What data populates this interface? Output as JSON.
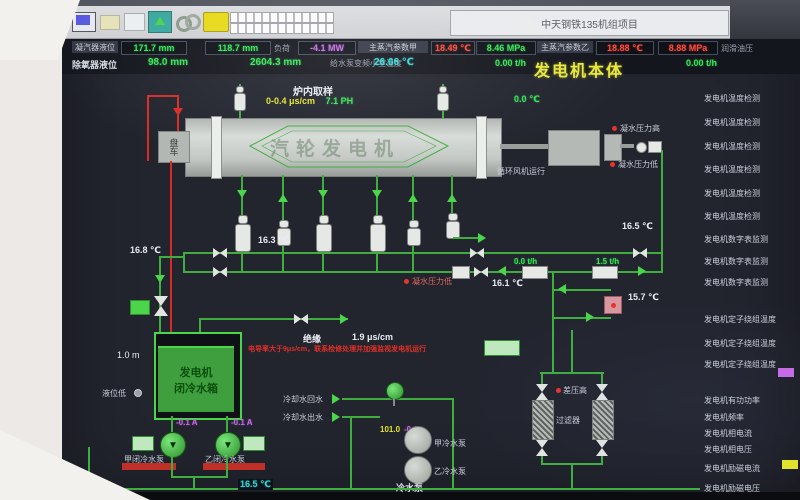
{
  "window": {
    "title": "中天钢铁135机组项目"
  },
  "toolbar": {
    "icon_names": [
      "monitor-icon",
      "open-icon",
      "page-icon",
      "trend-icon",
      "link-icon",
      "note-icon"
    ]
  },
  "status": {
    "row1": [
      {
        "label": "凝汽器液位"
      },
      {
        "value": "171.7 mm"
      },
      {
        "value": "118.7 mm"
      },
      {
        "label": "负荷"
      },
      {
        "value": "-4.1 MW"
      },
      {
        "label": "主蒸汽参数甲"
      },
      {
        "value": "18.49 ℃"
      },
      {
        "value": "8.46 MPa"
      },
      {
        "label": "主蒸汽参数乙"
      },
      {
        "value": "18.88 ℃"
      },
      {
        "value": "8.88 MPa"
      },
      {
        "label": "润滑油压"
      }
    ],
    "row2": [
      {
        "label": "除氧器液位"
      },
      {
        "value": "98.0 mm"
      },
      {
        "value": "2604.3 mm"
      },
      {
        "label": "给水泵变频小室温度"
      },
      {
        "value": "26.66 ℃"
      },
      {
        "value": "0.00 t/h"
      },
      {
        "value": "0.00 t/h"
      }
    ]
  },
  "diagram": {
    "title": "发电机本体",
    "generator_label": "汽轮发电机",
    "turning_gear": "盘车",
    "sampling_title": "炉内取样",
    "sampling_cond": "0-0.4 μs/cm",
    "sampling_ph": "7.1 PH",
    "fan_running": "循环风机运行",
    "press_high": "凝水压力高",
    "press_low": "凝水压力低",
    "press_low2": "凝水压力低",
    "t_top": "0.0 ℃",
    "t_168": "16.8 ℃",
    "t_163": "16.3 ℃",
    "t_165": "16.5 ℃",
    "t_161": "16.1 ℃",
    "t_157": "15.7 ℃",
    "t_bottom": "16.5 ℃",
    "f_00": "0.0 t/h",
    "f_15": "1.5 t/h",
    "insul_label": "绝缘",
    "insul_value": "1.9 μs/cm",
    "warning": "电导率大于9μs/cm，联系检修处理并加强监视发电机运行",
    "tank_line1": "发电机",
    "tank_line2": "闭冷水箱",
    "tank_level": "1.0 m",
    "level_low": "液位低",
    "pump_a": "甲闭冷水泵",
    "pump_b": "乙闭冷水泵",
    "pump_a_cur": "-0.1 A",
    "pump_b_cur": "-0.1 A",
    "cw_return": "冷却水回水",
    "cw_out": "冷却水出水",
    "mv_pos": "101.0",
    "mv_cur": "-0.1",
    "cwp_a": "甲冷水泵",
    "cwp_b": "乙冷水泵",
    "cwp": "冷水泵",
    "dp_high": "差压高",
    "filter_label": "过滤器"
  },
  "right_panel": {
    "items": [
      "发电机温度检测",
      "发电机温度检测",
      "发电机温度检测",
      "发电机温度检测",
      "发电机温度检测",
      "发电机温度检测",
      "发电机数字表监测",
      "发电机数字表监测",
      "发电机数字表监测",
      "发电机定子绕组温度",
      "发电机定子绕组温度",
      "发电机定子绕组温度",
      "发电机有功功率",
      "发电机频率",
      "发电机相电流",
      "发电机相电压",
      "发电机励磁电流",
      "发电机励磁电压"
    ]
  },
  "colors": {
    "line_green": "#3fae3f",
    "value_green": "#35e655",
    "teal": "#35d6d6",
    "alarm_red": "#e8342c",
    "magenta": "#c76ae8",
    "yellow": "#e3e32a",
    "title_yellow": "#e8e83c"
  }
}
